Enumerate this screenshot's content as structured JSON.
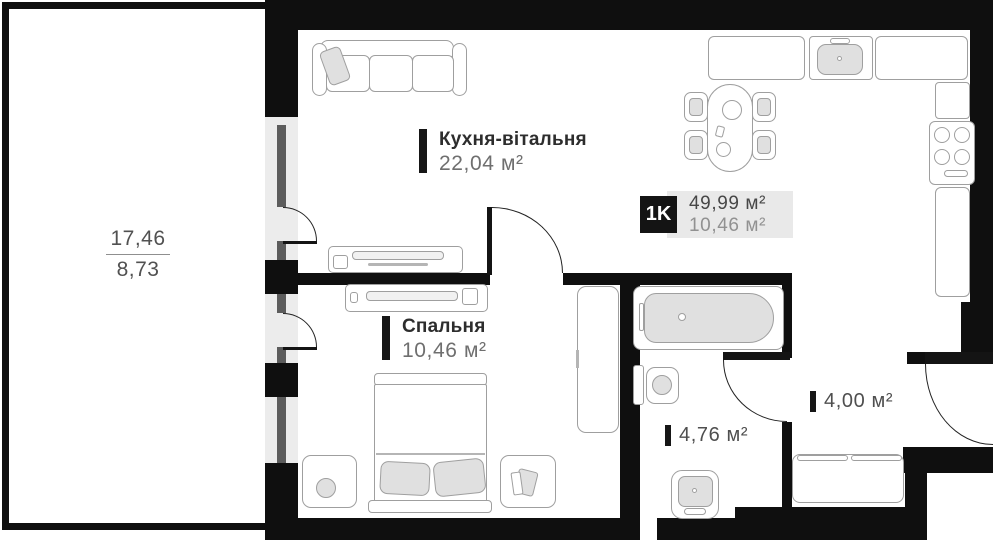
{
  "unit_badge": {
    "code": "1K",
    "total_area": "49,99 м²",
    "living_area": "10,46 м²"
  },
  "rooms": {
    "kitchen_living": {
      "name": "Кухня-вітальня",
      "area": "22,04 м²"
    },
    "bedroom": {
      "name": "Спальня",
      "area": "10,46 м²"
    },
    "bathroom": {
      "area": "4,76 м²"
    },
    "hallway": {
      "area": "4,00 м²"
    },
    "balcony": {
      "area_full": "17,46",
      "area_reduced": "8,73"
    }
  },
  "colors": {
    "wall": "#0f0f0f",
    "furniture_stroke": "#9f9f9f",
    "accent_fill": "#e0e0e0",
    "glass": "#5c5c5c",
    "badge_bg": "#e9e9e9",
    "badge_square": "#141414",
    "label_dark": "#2d2d2d",
    "label_gray": "#6f6f6f"
  }
}
